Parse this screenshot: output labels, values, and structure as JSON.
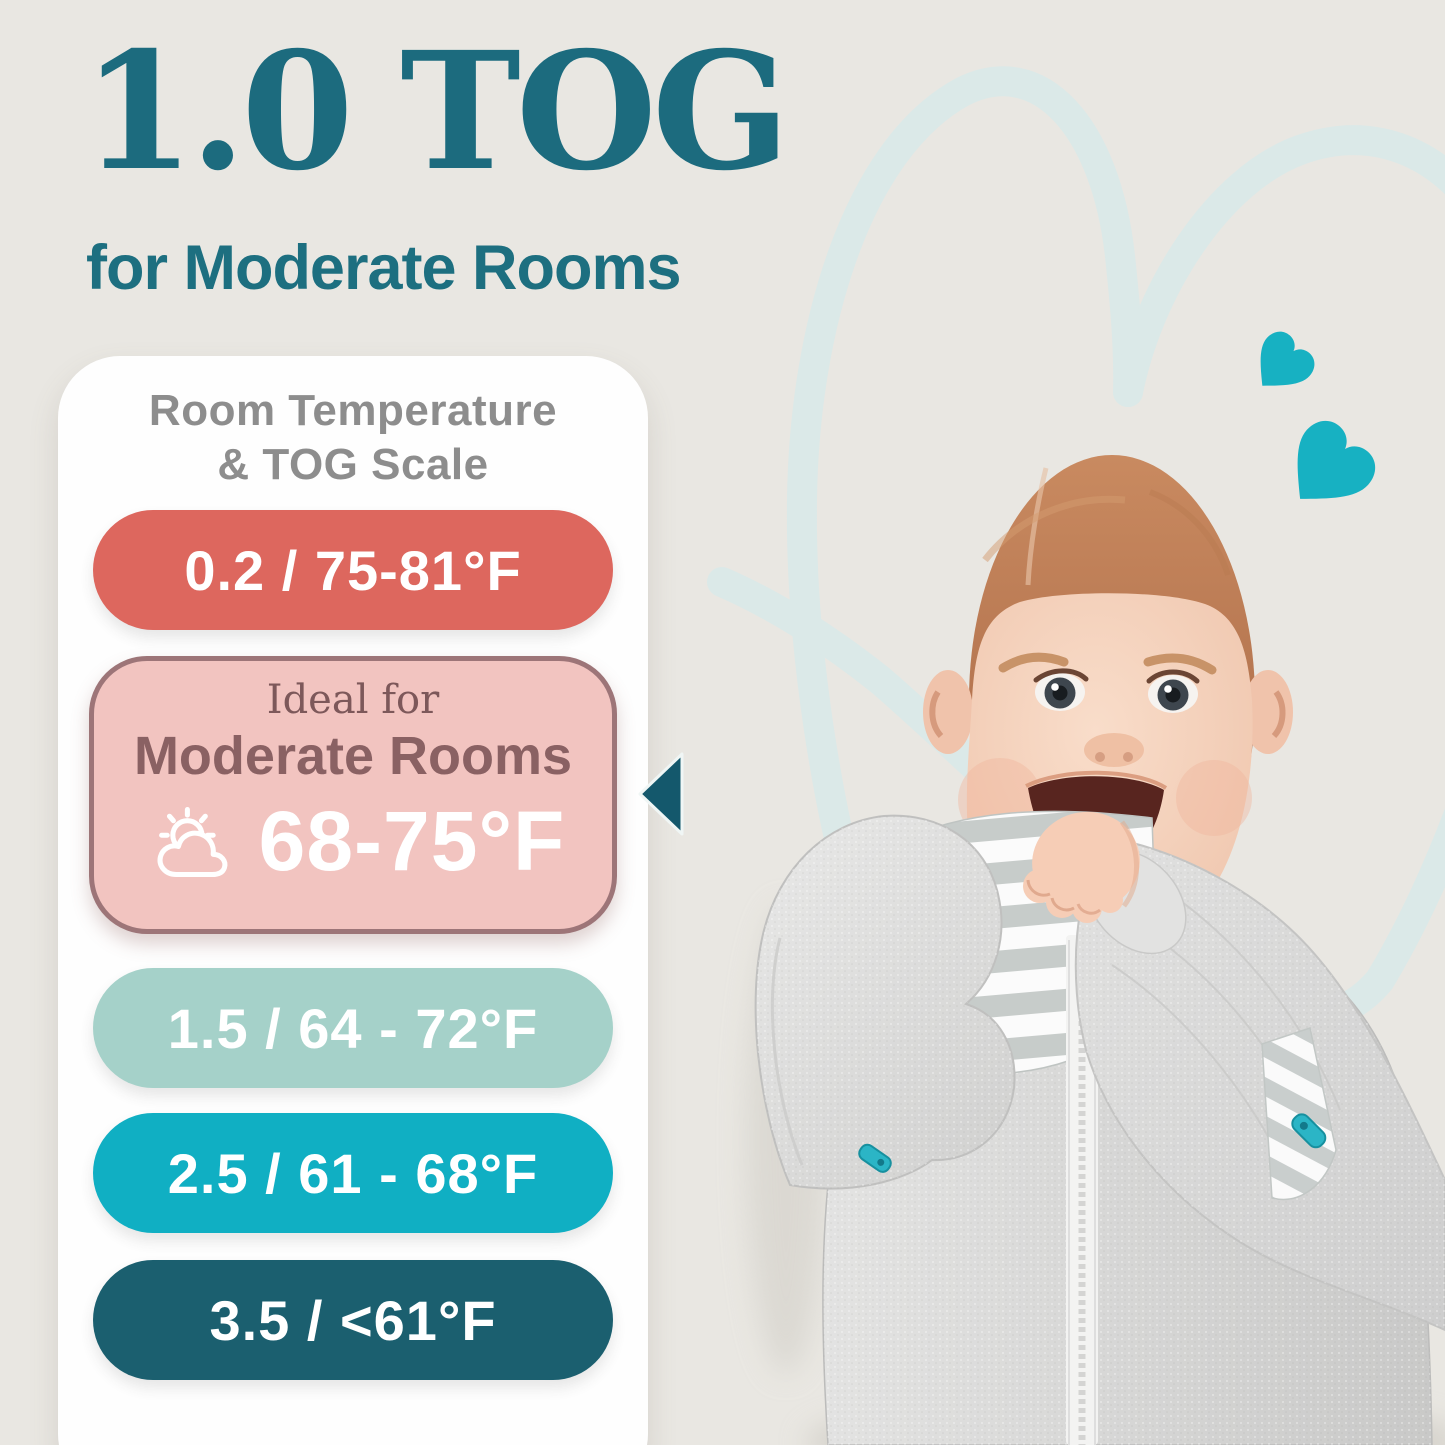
{
  "page": {
    "background_color": "#e9e7e2"
  },
  "header": {
    "title": "1.0 TOG",
    "subtitle": "for Moderate Rooms",
    "text_color": "#1c6b7e"
  },
  "tog_card": {
    "heading_line1": "Room Temperature",
    "heading_line2": "& TOG Scale",
    "rows": [
      {
        "type": "pill",
        "label": "0.2 / 75-81°F",
        "bg": "#dd675e",
        "text_color": "#ffffff"
      },
      {
        "type": "highlight",
        "ideal_label": "Ideal for",
        "room_label": "Moderate Rooms",
        "temp_label": "68-75°F",
        "bg": "#f2c4c0",
        "border_color": "#9d7578",
        "text_color": "#8a6163",
        "icon": "sun-behind-cloud-icon"
      },
      {
        "type": "pill",
        "label": "1.5 / 64 - 72°F",
        "bg": "#a5d1c9",
        "text_color": "#ffffff"
      },
      {
        "type": "pill",
        "label": "2.5 / 61 - 68°F",
        "bg": "#10afc3",
        "text_color": "#ffffff"
      },
      {
        "type": "pill",
        "label": "3.5 / <61°F",
        "bg": "#1b5f6f",
        "text_color": "#ffffff"
      }
    ],
    "pointer": {
      "points_to": "highlight row",
      "color": "#14586c"
    }
  },
  "decor": {
    "small_hearts_color": "#17b1c2",
    "heart_outline_color": "#dbe9e8"
  }
}
